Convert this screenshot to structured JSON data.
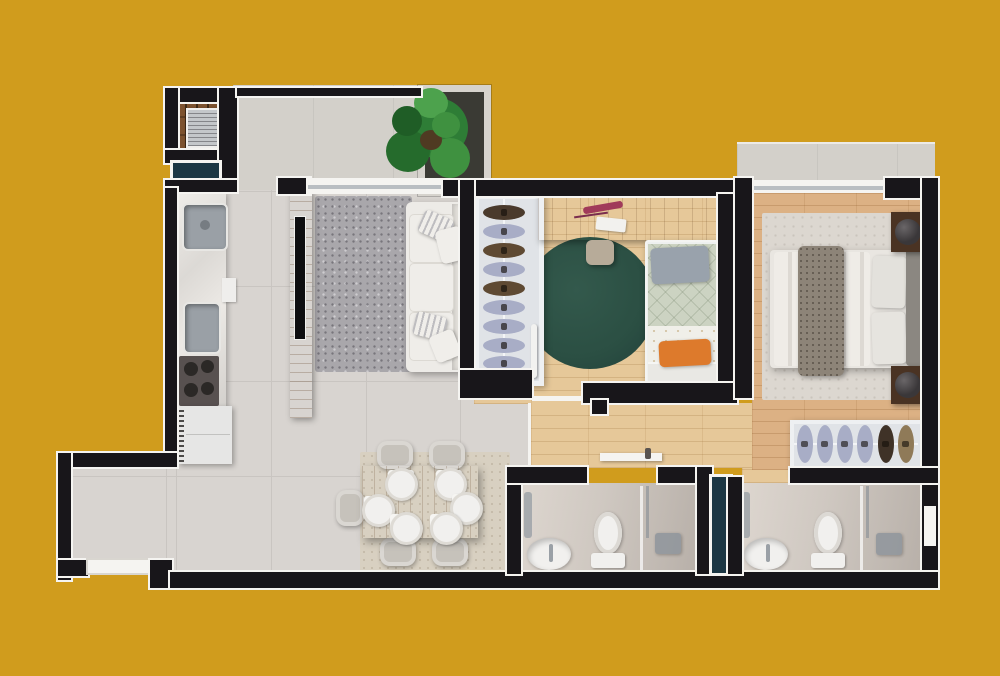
{
  "scene": {
    "description": "3D rendered apartment floor plan, top-down view, on mustard yellow background",
    "canvas": {
      "width": 1000,
      "height": 676
    },
    "visible_text": "none"
  },
  "palette": {
    "background": "#d09c1d",
    "wall": "#18161a",
    "trim": "#f5f4f1",
    "tile": "#d8d4d0",
    "tileJoint": "#c9c5c1",
    "terrace": "#d3d0ca",
    "woodBedroom": "#e6c899",
    "woodMaster": "#dcb184",
    "marble": "#ebe8e4",
    "livingRug": "#a9a7ab",
    "masterRug": "#dcd7d0",
    "diningRug": "#d8d0c1",
    "greenRug": "#2b4f43",
    "sofa": "#edebe7",
    "bedWhite": "#e9e6e1",
    "quiltSage": "#ccd3c2",
    "sheetWhite": "#f0efe9",
    "orangeAccent": "#dd7a2c",
    "pillowGray": "#99a2ac",
    "blanket": "#8d8478",
    "headboard": "#8b8781",
    "nightstand": "#4a3323",
    "lamp": "#3a3739",
    "woodFurniture": "#b5824c",
    "deckPlank": "#7d522f",
    "deckGap": "#402a16",
    "grillMetal": "#c4c7ca",
    "handleOrange": "#c96a2d",
    "teal": "#1c3744",
    "clothesLavender": "#a8adc6",
    "clothesBrown": "#5f4a33",
    "clothesTan": "#8f7a58",
    "closetBg": "#e0e3e7",
    "fixture": "#f1f0ee",
    "bathFloor": "#cfc8c1",
    "metal": "#9aa0a6",
    "stovePanel": "#585150",
    "burner": "#2b2826",
    "chair": "#c6c2bb",
    "glassLine": "#b9bec2",
    "plantGreen1": "#2e7d36",
    "plantGreen2": "#3f9140",
    "plantGreen3": "#256b2c",
    "plantGreen4": "#4da24d",
    "plantDark": "#1f5d26"
  },
  "rooms": [
    {
      "id": "barbecue-balcony",
      "furniture": [
        "wood deck",
        "grill",
        "two orange handles"
      ]
    },
    {
      "id": "service-window",
      "furniture": [
        "teal glass pane"
      ]
    },
    {
      "id": "kitchen",
      "furniture": [
        "marble counter",
        "double sink",
        "single sink",
        "4-burner cooktop",
        "refrigerator with coil"
      ]
    },
    {
      "id": "terrace",
      "furniture": [
        "large green potted plant in planter box"
      ]
    },
    {
      "id": "living-room",
      "furniture": [
        "speckled gray rug",
        "wood TV panel with TV",
        "white 3-seat sofa with 4 pillows",
        "window"
      ]
    },
    {
      "id": "bedroom",
      "furniture": [
        "wardrobe with 9 hanging clothes",
        "wood desk with stationery",
        "stool",
        "round dark-green rug",
        "single bed with sage quilt, gray pillow and orange pillow"
      ]
    },
    {
      "id": "master-bedroom",
      "furniture": [
        "window to balcony",
        "area rug",
        "double bed with gray throw blanket and two pillows",
        "dark headboard",
        "two nightstands with round lamps",
        "wardrobe with 6 hanging clothes"
      ]
    },
    {
      "id": "master-balcony",
      "furniture": []
    },
    {
      "id": "hallway",
      "furniture": [
        "white door leaf"
      ]
    },
    {
      "id": "dining-area",
      "furniture": [
        "beige rug",
        "wood table with 6 place settings",
        "5 chairs"
      ]
    },
    {
      "id": "entry",
      "furniture": [
        "entry door"
      ]
    },
    {
      "id": "bathroom",
      "furniture": [
        "oval sink",
        "toilet",
        "shower with glass partition",
        "towel rail"
      ]
    },
    {
      "id": "ensuite-bathroom",
      "furniture": [
        "oval sink",
        "toilet",
        "shower with glass partition",
        "towel rail",
        "window",
        "duct shaft"
      ]
    }
  ],
  "counts": {
    "bedroom_closet_items": 9,
    "master_wardrobe_items": 6,
    "dining_places": 6,
    "dining_chairs": 5
  }
}
